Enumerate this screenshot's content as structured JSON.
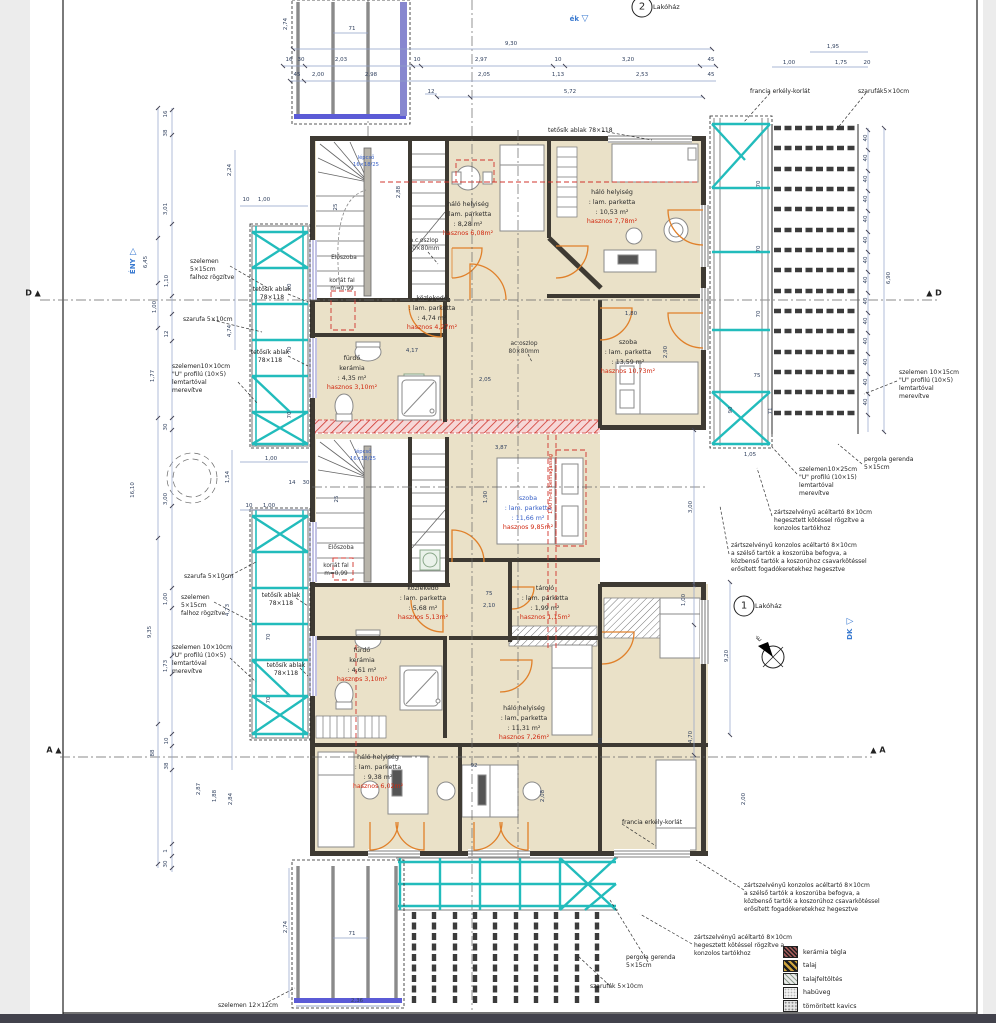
{
  "bad_colors_note": "",
  "colors": {
    "room_fill": "#eae1c8",
    "teal": "#22bcbc",
    "door_orange": "#e0802a",
    "red": "#d02810",
    "dim_blue": "#31415f",
    "accent_blue": "#3a7ad0"
  },
  "unit_badges": [
    {
      "num": "2",
      "label": "Lakóház",
      "cx": 642,
      "cy": 7
    },
    {
      "num": "1",
      "label": "Lakóház",
      "cx": 744,
      "cy": 606
    }
  ],
  "compass": {
    "label": "É",
    "x": 773,
    "y": 657
  },
  "direction_markers": [
    {
      "t": "ék",
      "x": 579,
      "y": 19,
      "tri": "▽",
      "v": false
    },
    {
      "t": "ÉNY",
      "x": 133,
      "y": 260,
      "tri": "▽",
      "v": true
    },
    {
      "t": "DK",
      "x": 850,
      "y": 628,
      "tri": "◁",
      "v": true
    }
  ],
  "section_markers": [
    {
      "l": "D ▲",
      "x": 33,
      "y": 293
    },
    {
      "l": "▲ D",
      "x": 934,
      "y": 293
    },
    {
      "l": "A ▲",
      "x": 54,
      "y": 750
    },
    {
      "l": "▲ A",
      "x": 878,
      "y": 750
    }
  ],
  "rooms": [
    {
      "name": "háló helyiség",
      "finish": ": lam. parketta",
      "area": ": 8,28 m²",
      "useful": "hasznos 6,08m²",
      "x": 468,
      "y": 200,
      "blue": false
    },
    {
      "name": "háló helyiség",
      "finish": ": lam. parketta",
      "area": ": 10,53 m²",
      "useful": "hasznos 7,78m²",
      "x": 612,
      "y": 188,
      "blue": false
    },
    {
      "name": "közlekedő",
      "finish": ": lam. parketta",
      "area": ": 4,74 m²",
      "useful": "hasznos 4,27m²",
      "x": 432,
      "y": 294,
      "blue": false
    },
    {
      "name": "fürdő",
      "finish": "kerámia",
      "area": ": 4,35 m²",
      "useful": "hasznos 3,10m²",
      "x": 352,
      "y": 354,
      "blue": false
    },
    {
      "name": "szoba",
      "finish": ": lam. parketta",
      "area": ": 13,59 m²",
      "useful": "hasznos 10,73m²",
      "x": 628,
      "y": 338,
      "blue": false
    },
    {
      "name": "szoba",
      "finish": ": lam. parketta",
      "area": ": 11,66 m²",
      "useful": "hasznos 9,85m²",
      "x": 528,
      "y": 494,
      "blue": true
    },
    {
      "name": "közlekedő",
      "finish": ": lam. parketta",
      "area": ": 5,68 m²",
      "useful": "hasznos 5,13m²",
      "x": 423,
      "y": 584,
      "blue": false
    },
    {
      "name": "tároló",
      "finish": ": lam. parketta",
      "area": ": 1,99 m²",
      "useful": "hasznos 1,15m²",
      "x": 545,
      "y": 584,
      "blue": false
    },
    {
      "name": "fürdő",
      "finish": "kerámia",
      "area": ": 4,61 m²",
      "useful": "hasznos 3,10m²",
      "x": 362,
      "y": 646,
      "blue": false
    },
    {
      "name": "háló helyiség",
      "finish": ": lam. parketta",
      "area": ": 11,31 m²",
      "useful": "hasznos 7,26m²",
      "x": 524,
      "y": 704,
      "blue": false
    },
    {
      "name": "háló helyiség",
      "finish": ": lam. parketta",
      "area": ": 9,38 m²",
      "useful": "hasznos 6,02m²",
      "x": 378,
      "y": 753,
      "blue": false
    }
  ],
  "plain_labels": [
    {
      "t": "Előszoba",
      "x": 344,
      "y": 255,
      "c": "k"
    },
    {
      "t": "korlát fal\nm=0,99",
      "x": 342,
      "y": 278,
      "c": "k"
    },
    {
      "t": "Előszoba",
      "x": 341,
      "y": 545,
      "c": "k"
    },
    {
      "t": "korlát fal\nm=0,99",
      "x": 336,
      "y": 563,
      "c": "k"
    },
    {
      "t": "lépcső\n16×18/25",
      "x": 366,
      "y": 155,
      "c": "b"
    },
    {
      "t": "lépcső\n16×18/25",
      "x": 363,
      "y": 449,
      "c": "b"
    },
    {
      "t": "a.c.oszlop\n80×80mm",
      "x": 424,
      "y": 238,
      "c": "k"
    },
    {
      "t": "ac.oszlop\n80×80mm",
      "x": 524,
      "y": 341,
      "c": "k"
    },
    {
      "t": "1,90 m-es belmagasság",
      "x": 551,
      "y": 484,
      "c": "r"
    }
  ],
  "annotations": [
    {
      "text": "szelemen\n5×15cm\nfalhoz rögzítve",
      "x": 190,
      "y": 258,
      "center": false
    },
    {
      "text": "szarufa 5×10cm",
      "x": 183,
      "y": 316,
      "center": false
    },
    {
      "text": "tetősík ablak\n78×118",
      "x": 272,
      "y": 286,
      "center": true
    },
    {
      "text": "tetősík ablak\n78×118",
      "x": 270,
      "y": 349,
      "center": true
    },
    {
      "text": "szelemen10×10cm\n\"U\" profilú (10×5)\nlemtartóval\nmerevítve",
      "x": 172,
      "y": 363,
      "center": false
    },
    {
      "text": "szarufa 5×10cm",
      "x": 184,
      "y": 573,
      "center": false
    },
    {
      "text": "szelemen\n5×15cm\nfalhoz rögzítve",
      "x": 181,
      "y": 594,
      "center": false
    },
    {
      "text": "tetősík ablak\n78×118",
      "x": 281,
      "y": 592,
      "center": true
    },
    {
      "text": "tetősík ablak\n78×118",
      "x": 286,
      "y": 662,
      "center": true
    },
    {
      "text": "szelemen 10×10cm\n\"U\" profilú (10×5)\nlemtartóval\nmerevítve",
      "x": 172,
      "y": 644,
      "center": false
    },
    {
      "text": "szelemen 12×12cm",
      "x": 218,
      "y": 1002,
      "center": false
    },
    {
      "text": "pergola gerenda\n5×15cm",
      "x": 626,
      "y": 954,
      "center": false
    },
    {
      "text": "szarufák 5×10cm",
      "x": 590,
      "y": 983,
      "center": false
    },
    {
      "text": "zártszelvényű acéltartó 8×10cm\nhegesztett kötéssel rögzítve a\nkonzolos tartókhoz",
      "x": 694,
      "y": 934,
      "center": false
    },
    {
      "text": "zártszelvényű konzolos acéltartó 8×10cm\na szélső tartók a koszorúba befogva, a\nközbenső tartók a koszorúhoz csavarkötéssel\nerősített fogadókeretekhez hegesztve",
      "x": 744,
      "y": 882,
      "center": false
    },
    {
      "text": "francia erkély-korlát",
      "x": 750,
      "y": 88,
      "center": false
    },
    {
      "text": "szarufák5×10cm",
      "x": 858,
      "y": 88,
      "center": false
    },
    {
      "text": "szelemen 10×15cm\n\"U\" profilú (10×5)\nlemtartóval\nmerevítve",
      "x": 899,
      "y": 369,
      "center": false
    },
    {
      "text": "pergola gerenda\n5×15cm",
      "x": 864,
      "y": 456,
      "center": false
    },
    {
      "text": "szelemen10×25cm\n\"U\" profilú (10×15)\nlemtartóval\nmerevítve",
      "x": 799,
      "y": 466,
      "center": false
    },
    {
      "text": "zártszelvényű acéltartó 8×10cm\nhegesztett kötéssel rögzítve a\nkonzolos tartókhoz",
      "x": 774,
      "y": 509,
      "center": false
    },
    {
      "text": "zártszelvényű konzolos acéltartó 8×10cm\na szélső tartók a koszorúba befogva, a\nközbenső tartók a koszorúhoz csavarkötéssel\nerősített fogadókeretekhez hegesztve",
      "x": 731,
      "y": 542,
      "center": false
    },
    {
      "text": "tetősík ablak 78×118",
      "x": 548,
      "y": 127,
      "center": false
    },
    {
      "text": "francia erkély-korlát",
      "x": 622,
      "y": 819,
      "center": false
    }
  ],
  "dims": [
    {
      "t": "71",
      "x": 352,
      "y": 29
    },
    {
      "t": "2,74",
      "x": 286,
      "y": 24,
      "r": -90
    },
    {
      "t": "9,30",
      "x": 511,
      "y": 44
    },
    {
      "t": "16",
      "x": 289,
      "y": 60
    },
    {
      "t": "30",
      "x": 301,
      "y": 60
    },
    {
      "t": "2,03",
      "x": 341,
      "y": 60
    },
    {
      "t": "10",
      "x": 417,
      "y": 60
    },
    {
      "t": "2,97",
      "x": 481,
      "y": 60
    },
    {
      "t": "10",
      "x": 558,
      "y": 60
    },
    {
      "t": "3,20",
      "x": 628,
      "y": 60
    },
    {
      "t": "45",
      "x": 711,
      "y": 60
    },
    {
      "t": "45",
      "x": 297,
      "y": 75
    },
    {
      "t": "2,00",
      "x": 318,
      "y": 75
    },
    {
      "t": "2,98",
      "x": 371,
      "y": 75
    },
    {
      "t": "2,05",
      "x": 484,
      "y": 75
    },
    {
      "t": "1,13",
      "x": 558,
      "y": 75
    },
    {
      "t": "2,53",
      "x": 642,
      "y": 75
    },
    {
      "t": "45",
      "x": 711,
      "y": 75
    },
    {
      "t": "12",
      "x": 431,
      "y": 92
    },
    {
      "t": "5,72",
      "x": 570,
      "y": 92
    },
    {
      "t": "1,95",
      "x": 833,
      "y": 47
    },
    {
      "t": "1,00",
      "x": 789,
      "y": 63
    },
    {
      "t": "1,75",
      "x": 841,
      "y": 63
    },
    {
      "t": "20",
      "x": 867,
      "y": 63
    },
    {
      "t": "16",
      "x": 166,
      "y": 114,
      "r": -90
    },
    {
      "t": "38",
      "x": 166,
      "y": 133,
      "r": -90
    },
    {
      "t": "2,24",
      "x": 230,
      "y": 170,
      "r": -90
    },
    {
      "t": "3,01",
      "x": 166,
      "y": 209,
      "r": -90
    },
    {
      "t": "6,45",
      "x": 146,
      "y": 262,
      "r": -90
    },
    {
      "t": "1,10",
      "x": 167,
      "y": 281,
      "r": -90
    },
    {
      "t": "1,00",
      "x": 155,
      "y": 307,
      "r": -90
    },
    {
      "t": "12",
      "x": 167,
      "y": 334,
      "r": -90
    },
    {
      "t": "4,74",
      "x": 230,
      "y": 331,
      "r": -90
    },
    {
      "t": "1,77",
      "x": 153,
      "y": 376,
      "r": -90
    },
    {
      "t": "10",
      "x": 246,
      "y": 200
    },
    {
      "t": "1,00",
      "x": 264,
      "y": 200
    },
    {
      "t": "30",
      "x": 166,
      "y": 427,
      "r": -90
    },
    {
      "t": "16,10",
      "x": 133,
      "y": 490,
      "r": -90
    },
    {
      "t": "3,00",
      "x": 166,
      "y": 499,
      "r": -90
    },
    {
      "t": "1,54",
      "x": 228,
      "y": 477,
      "r": -90
    },
    {
      "t": "1,00",
      "x": 271,
      "y": 459
    },
    {
      "t": "14",
      "x": 292,
      "y": 483
    },
    {
      "t": "30",
      "x": 306,
      "y": 483
    },
    {
      "t": "10",
      "x": 249,
      "y": 506
    },
    {
      "t": "1,00",
      "x": 269,
      "y": 506
    },
    {
      "t": "9,35",
      "x": 150,
      "y": 632,
      "r": -90
    },
    {
      "t": "1,00",
      "x": 166,
      "y": 599,
      "r": -90
    },
    {
      "t": "1,73",
      "x": 166,
      "y": 666,
      "r": -90
    },
    {
      "t": "4,73",
      "x": 228,
      "y": 610,
      "r": -90
    },
    {
      "t": "10",
      "x": 167,
      "y": 741,
      "r": -90
    },
    {
      "t": "88",
      "x": 153,
      "y": 753,
      "r": -90
    },
    {
      "t": "38",
      "x": 167,
      "y": 766,
      "r": -90
    },
    {
      "t": "2,87",
      "x": 199,
      "y": 789,
      "r": -90
    },
    {
      "t": "1,88",
      "x": 215,
      "y": 796,
      "r": -90
    },
    {
      "t": "2,84",
      "x": 231,
      "y": 799,
      "r": -90
    },
    {
      "t": "1",
      "x": 166,
      "y": 851,
      "r": -90
    },
    {
      "t": "30",
      "x": 166,
      "y": 864,
      "r": -90
    },
    {
      "t": "2,74",
      "x": 286,
      "y": 927,
      "r": -90
    },
    {
      "t": "71",
      "x": 352,
      "y": 934
    },
    {
      "t": "2,36",
      "x": 357,
      "y": 1001
    },
    {
      "t": "40",
      "x": 866,
      "y": 138,
      "r": -90
    },
    {
      "t": "40",
      "x": 866,
      "y": 158,
      "r": -90
    },
    {
      "t": "40",
      "x": 866,
      "y": 179,
      "r": -90
    },
    {
      "t": "40",
      "x": 866,
      "y": 199,
      "r": -90
    },
    {
      "t": "40",
      "x": 866,
      "y": 219,
      "r": -90
    },
    {
      "t": "40",
      "x": 866,
      "y": 240,
      "r": -90
    },
    {
      "t": "40",
      "x": 866,
      "y": 260,
      "r": -90
    },
    {
      "t": "40",
      "x": 866,
      "y": 280,
      "r": -90
    },
    {
      "t": "40",
      "x": 866,
      "y": 301,
      "r": -90
    },
    {
      "t": "40",
      "x": 866,
      "y": 321,
      "r": -90
    },
    {
      "t": "40",
      "x": 866,
      "y": 341,
      "r": -90
    },
    {
      "t": "40",
      "x": 866,
      "y": 362,
      "r": -90
    },
    {
      "t": "40",
      "x": 866,
      "y": 382,
      "r": -90
    },
    {
      "t": "40",
      "x": 866,
      "y": 402,
      "r": -90
    },
    {
      "t": "6,90",
      "x": 889,
      "y": 278,
      "r": -90
    },
    {
      "t": "70",
      "x": 759,
      "y": 184,
      "r": -90
    },
    {
      "t": "70",
      "x": 759,
      "y": 249,
      "r": -90
    },
    {
      "t": "70",
      "x": 759,
      "y": 314,
      "r": -90
    },
    {
      "t": "75",
      "x": 757,
      "y": 376
    },
    {
      "t": "90",
      "x": 731,
      "y": 410,
      "r": -90
    },
    {
      "t": "71",
      "x": 771,
      "y": 411,
      "r": -90
    },
    {
      "t": "1,05",
      "x": 750,
      "y": 455
    },
    {
      "t": "3,00",
      "x": 691,
      "y": 507,
      "r": -90
    },
    {
      "t": "9,20",
      "x": 727,
      "y": 656,
      "r": -90
    },
    {
      "t": "4,70",
      "x": 691,
      "y": 737,
      "r": -90
    },
    {
      "t": "1,00",
      "x": 684,
      "y": 600,
      "r": -90
    },
    {
      "t": "70",
      "x": 290,
      "y": 287,
      "r": -90
    },
    {
      "t": "70",
      "x": 290,
      "y": 350,
      "r": -90
    },
    {
      "t": "70",
      "x": 290,
      "y": 415,
      "r": -90
    },
    {
      "t": "70",
      "x": 269,
      "y": 637,
      "r": -90
    },
    {
      "t": "70",
      "x": 269,
      "y": 700,
      "r": -90
    },
    {
      "t": "4,17",
      "x": 412,
      "y": 351
    },
    {
      "t": "2,05",
      "x": 485,
      "y": 380
    },
    {
      "t": "3,87",
      "x": 501,
      "y": 448
    },
    {
      "t": "1,90",
      "x": 486,
      "y": 497,
      "r": -90
    },
    {
      "t": "1,80",
      "x": 631,
      "y": 314
    },
    {
      "t": "2,90",
      "x": 666,
      "y": 352,
      "r": -90
    },
    {
      "t": "75",
      "x": 489,
      "y": 594
    },
    {
      "t": "2,10",
      "x": 489,
      "y": 606
    },
    {
      "t": "92",
      "x": 474,
      "y": 766
    },
    {
      "t": "2,08",
      "x": 543,
      "y": 796,
      "r": -90
    },
    {
      "t": "90",
      "x": 601,
      "y": 741,
      "r": -90
    },
    {
      "t": "2,00",
      "x": 744,
      "y": 799,
      "r": -90
    },
    {
      "t": "25",
      "x": 336,
      "y": 207,
      "r": -90
    },
    {
      "t": "25",
      "x": 337,
      "y": 499,
      "r": -90
    },
    {
      "t": "2,88",
      "x": 399,
      "y": 192,
      "r": -90
    }
  ],
  "legend": {
    "x": 783,
    "y": 946,
    "row": 13.5,
    "items": [
      {
        "label": "kerámia tégla",
        "cls": "p-brick"
      },
      {
        "label": "talaj",
        "cls": "p-talaj"
      },
      {
        "label": "talajfeltöltés",
        "cls": "p-felt"
      },
      {
        "label": "habüveg",
        "cls": "p-hab"
      },
      {
        "label": "tömörített kavics",
        "cls": "p-kav"
      }
    ]
  }
}
